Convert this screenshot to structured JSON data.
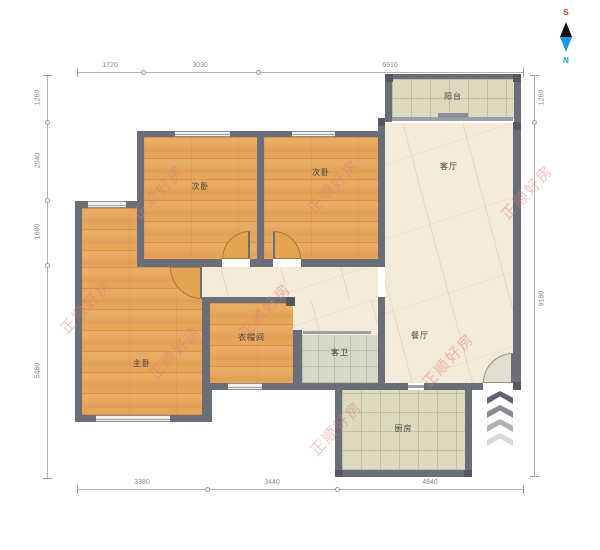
{
  "compass": {
    "south": "S",
    "north": "N"
  },
  "watermark": {
    "text": "正顺好房"
  },
  "rooms": {
    "balcony": {
      "label": "阳台"
    },
    "living": {
      "label": "客厅"
    },
    "dining": {
      "label": "餐厅"
    },
    "bath": {
      "label": "客卫"
    },
    "kitchen": {
      "label": "厨房"
    },
    "bedroom_left": {
      "label": "次卧"
    },
    "bedroom_right": {
      "label": "次卧"
    },
    "master": {
      "label": "主卧"
    },
    "cloakroom": {
      "label": "衣帽间"
    }
  },
  "dimensions": {
    "top": [
      "1720",
      "3030",
      "6910"
    ],
    "bottom": [
      "3380",
      "3440",
      "4840"
    ],
    "left": [
      "1260",
      "2040",
      "1680",
      "5460"
    ],
    "right": [
      "1260",
      "9180"
    ]
  },
  "colors": {
    "wall": "#6a6e79",
    "wood_floor": "#e8a558",
    "marble_floor": "#f4ead8",
    "tile_floor": "#dcd9bf",
    "bath_floor": "#d7d9c7",
    "watermark": "#db7b74",
    "compass_south": "#c0392b",
    "compass_north": "#1b9cd8"
  }
}
